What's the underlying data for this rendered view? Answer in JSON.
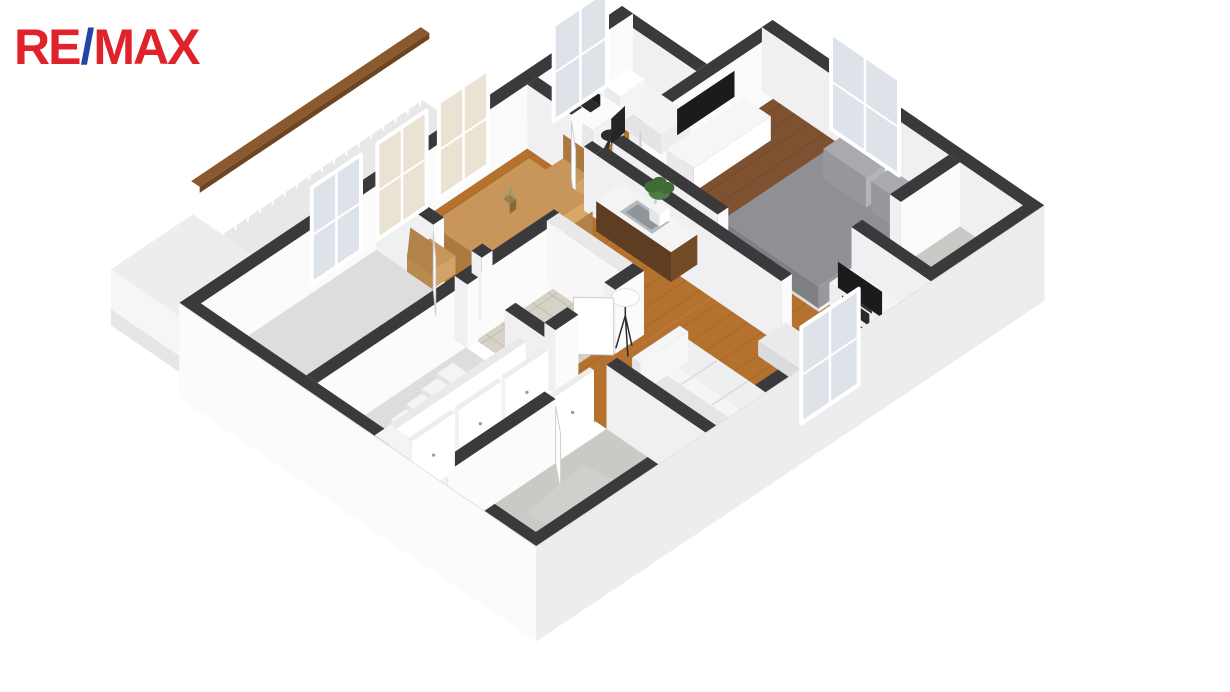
{
  "page": {
    "background": "#ffffff",
    "description": "3D axonometric cutaway floor plan render of an apartment"
  },
  "logo": {
    "re": "RE",
    "slash": "/",
    "max": "MAX"
  },
  "colors": {
    "brand_red": "#e0232b",
    "brand_blue": "#2147a3",
    "wall_top": "#3a3a3c",
    "wall_face": "#f0f0f2",
    "wall_face_lit": "#fbfbfc",
    "white_wall_top": "#e9e9ea",
    "skirt_nw": "#f5f5f6",
    "skirt_sw": "#fbfbfc",
    "skirt_se": "#ededef",
    "floor_oak": "#b5722f",
    "oak_line": "#8f5518",
    "floor_walnut": "#7e5230",
    "walnut_line": "#5d3a1e",
    "floor_concrete": "#c9c9c5",
    "concrete_spot": "#d4d4d0",
    "floor_tile": "#d7d2c6",
    "tile_line": "#c2bdb0",
    "floor_pale": "#dddddb",
    "deck": "#e8e8e9",
    "rail_wood": "#8a5a2e",
    "rail_wood_dark": "#6e4523",
    "glass_cool": "#dde3e8",
    "glass_warm": "#eae2d3",
    "frame_white": "#ffffff",
    "sofa_white": "#edeff0",
    "sofa_light": "#f4f5f6",
    "bed_gray": "#8e9094",
    "pillow_gray": "#a8aaad",
    "bed_white": "#f3f3f4",
    "table_oak": "#c8955a",
    "table_oak_side": "#aa7a40",
    "cabinet_walnut": "#5f3d22",
    "counter_white": "#f4f4f5",
    "steel": "#b4babd",
    "steel_dark": "#8f9598",
    "tv_black": "#1b1b1d",
    "chair_black": "#2e2e30",
    "plant_green": "#4e7d42",
    "plant_green_dark": "#3f6b35",
    "pot_white": "#f5f5f5",
    "flower_pink": "#d98ab2",
    "lamp_white": "#fdfdfd",
    "door_white": "#ffffff",
    "shelf_slot": "#2a2a2c",
    "shelf_item": "#6b7f94"
  },
  "floorplan": {
    "view": "axonometric-3d-cutaway",
    "rooms": [
      {
        "name": "balcony",
        "floor": "deck",
        "features": [
          "wood-capped railing",
          "white parapet"
        ]
      },
      {
        "name": "study",
        "floor": "oak",
        "features": [
          "single bed",
          "desk",
          "laptop",
          "office chair",
          "window"
        ]
      },
      {
        "name": "bedroom",
        "floor": "walnut",
        "features": [
          "gray double bed",
          "wall tv",
          "white dresser",
          "potted plant",
          "window",
          "door"
        ]
      },
      {
        "name": "storage-room",
        "floor": "concrete",
        "features": []
      },
      {
        "name": "living-room",
        "floor": "oak",
        "features": [
          "white sofa",
          "coffee table",
          "tv console",
          "tv",
          "potted plants",
          "pink flowers",
          "window"
        ]
      },
      {
        "name": "dining-room",
        "floor": "oak",
        "features": [
          "dining table",
          "four chairs",
          "vase with sprigs",
          "two windows",
          "balcony door"
        ]
      },
      {
        "name": "kitchenette",
        "floor": "oak",
        "features": [
          "counter",
          "steel sink",
          "faucet"
        ]
      },
      {
        "name": "hallway",
        "floor": "oak",
        "features": [
          "tripod floor lamp",
          "curved white wall"
        ]
      },
      {
        "name": "bathroom",
        "floor": "tile",
        "features": []
      },
      {
        "name": "staircase",
        "floor": "pale",
        "features": [
          "descending steps",
          "white side wall"
        ]
      },
      {
        "name": "utility-room",
        "floor": "pale",
        "features": []
      },
      {
        "name": "corridor",
        "floor": "oak",
        "features": [
          "white closet doors"
        ]
      },
      {
        "name": "bottom-room",
        "floor": "concrete",
        "features": []
      }
    ]
  }
}
